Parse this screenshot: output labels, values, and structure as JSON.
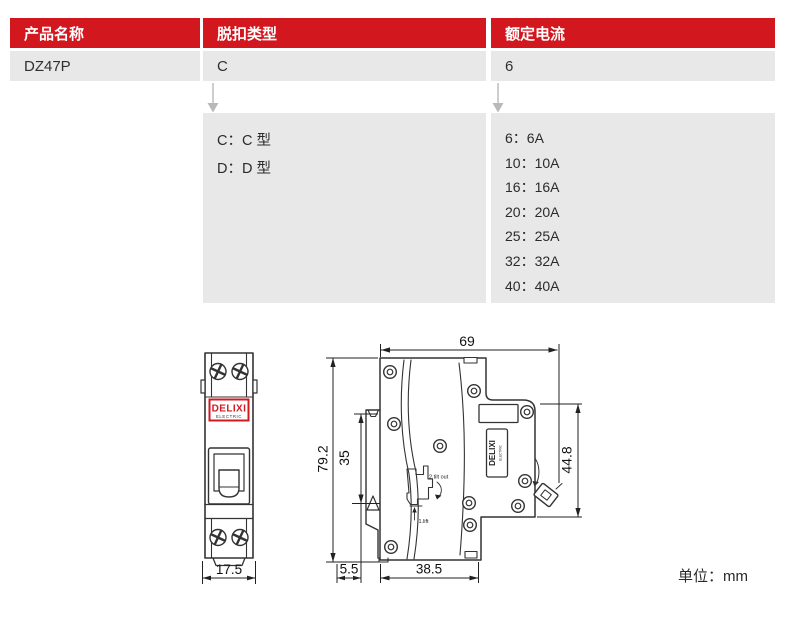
{
  "table": {
    "columns": [
      {
        "header": "产品名称",
        "value": "DZ47P"
      },
      {
        "header": "脱扣类型",
        "value": "C"
      },
      {
        "header": "额定电流",
        "value": "6"
      }
    ]
  },
  "legend": {
    "trip_types": [
      {
        "label": "C：C 型"
      },
      {
        "label": "D：D 型"
      }
    ],
    "ratings": [
      {
        "label": "6：6A"
      },
      {
        "label": "10：10A"
      },
      {
        "label": "16：16A"
      },
      {
        "label": "20：20A"
      },
      {
        "label": "25：25A"
      },
      {
        "label": "32：32A"
      },
      {
        "label": "40：40A"
      }
    ]
  },
  "drawing": {
    "brand": "DELIXI",
    "brand_sub": "ELECTRIC",
    "front_width": "17.5",
    "side": {
      "overall_depth": "69",
      "overall_height": "79.2",
      "din_rail": "35",
      "front_height": "44.8",
      "rail_offset": "5.5",
      "body_depth": "38.5",
      "note_tilt": "2.tilt out",
      "note_lift": "1.lift"
    },
    "unit_label": "单位：mm"
  },
  "colors": {
    "header_red": "#d2171f",
    "cell_gray": "#e9e8e8",
    "brand_red": "#cf1a20",
    "line_dark": "#333333",
    "arrow_gray": "#b9b9b9"
  }
}
